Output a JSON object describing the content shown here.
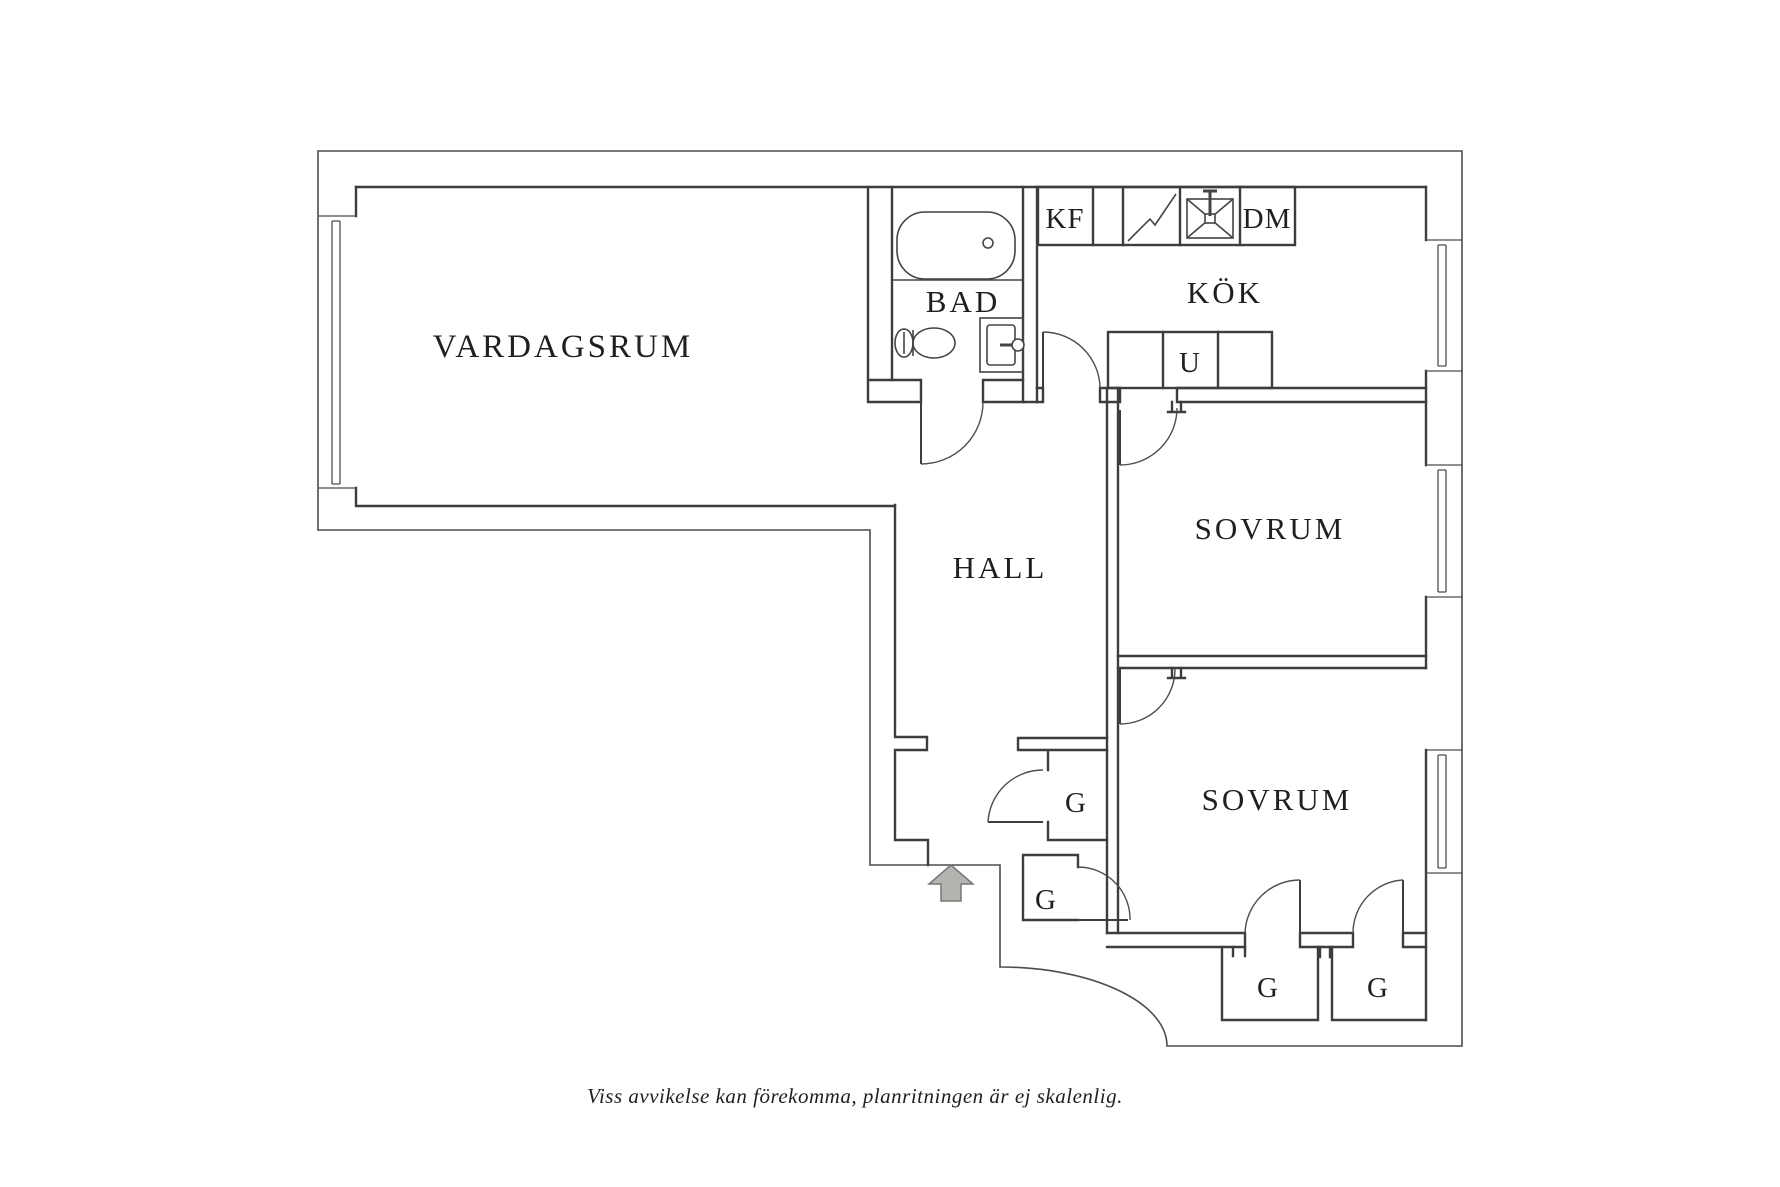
{
  "floorplan": {
    "rooms": {
      "living_room": "VARDAGSRUM",
      "bathroom": "BAD",
      "kitchen": "KÖK",
      "hall": "HALL",
      "bedroom_1": "SOVRUM",
      "bedroom_2": "SOVRUM"
    },
    "kitchen_units": {
      "fridge_freezer": "KF",
      "dishwasher": "DM",
      "cabinet_u": "U"
    },
    "closets": [
      "G",
      "G",
      "G",
      "G"
    ],
    "caption": "Viss avvikelse kan förekomma, planritningen är ej skalenlig.",
    "colors": {
      "background": "#ffffff",
      "wall": "#3d3d3d",
      "outline": "#4d4d4d",
      "text": "#1f1f1f",
      "entry_arrow_fill": "#b3b3b0",
      "entry_arrow_stroke": "#777777"
    }
  }
}
